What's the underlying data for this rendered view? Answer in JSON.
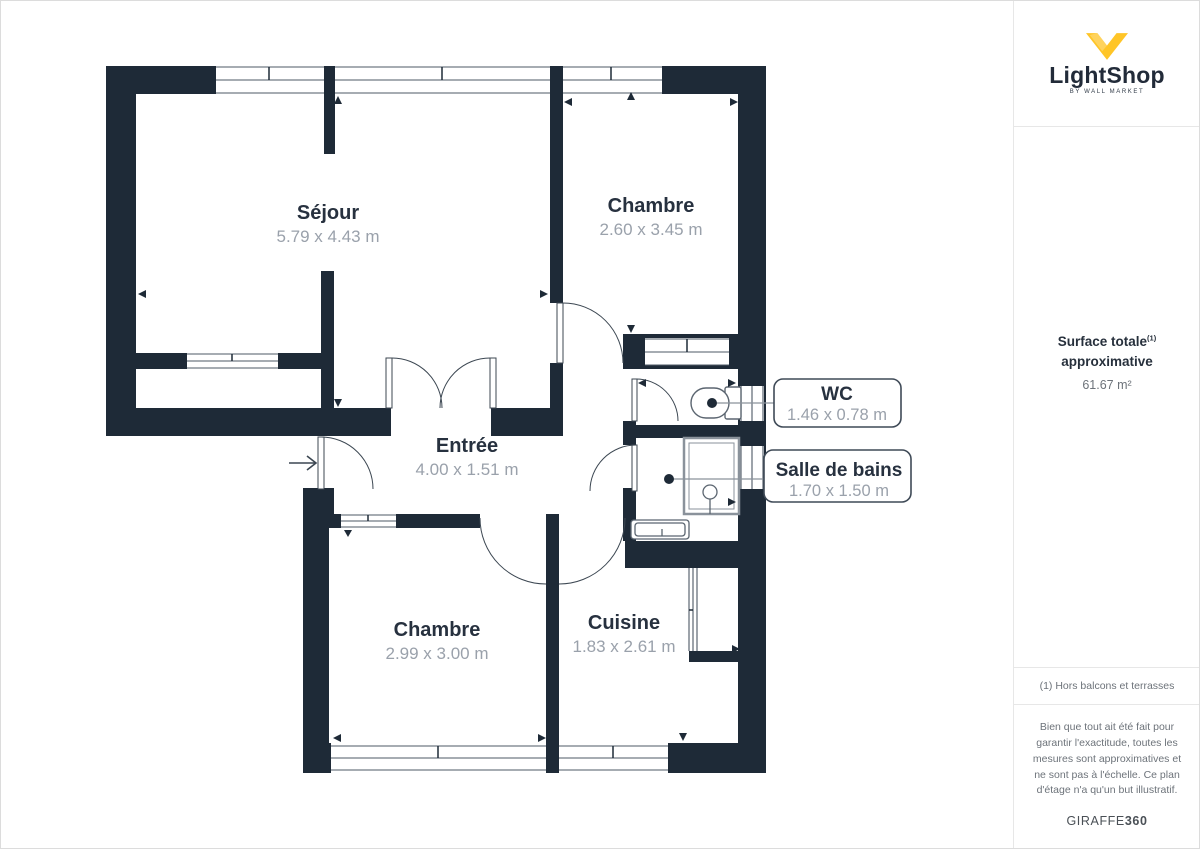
{
  "branding": {
    "logo_text": "LightShop",
    "logo_sub": "BY WALL MARKET",
    "footer_brand_regular": "GIRAFFE",
    "footer_brand_bold": "360"
  },
  "sidebar": {
    "surface_title_line1": "Surface totale",
    "surface_title_sup": "(1)",
    "surface_title_line2": "approximative",
    "surface_value": "61.67 m²",
    "note": "(1) Hors balcons et terrasses",
    "disclaimer": "Bien que tout ait été fait pour garantir l'exactitude, toutes les mesures sont approximatives et ne sont pas à l'échelle. Ce plan d'étage n'a qu'un but illustratif."
  },
  "rooms": {
    "sejour": {
      "name": "Séjour",
      "dims": "5.79 x 4.43 m"
    },
    "chambre1": {
      "name": "Chambre",
      "dims": "2.60 x 3.45 m"
    },
    "entree": {
      "name": "Entrée",
      "dims": "4.00 x 1.51 m"
    },
    "wc": {
      "name": "WC",
      "dims": "1.46 x 0.78 m"
    },
    "sdb": {
      "name": "Salle de bains",
      "dims": "1.70 x 1.50 m"
    },
    "chambre2": {
      "name": "Chambre",
      "dims": "2.99 x 3.00 m"
    },
    "cuisine": {
      "name": "Cuisine",
      "dims": "1.83 x 2.61 m"
    }
  },
  "colors": {
    "wall": "#1e2a37",
    "logo_yellow": "#ffc527",
    "dims_gray": "#9aa1ab",
    "title_navy": "#27313f"
  }
}
